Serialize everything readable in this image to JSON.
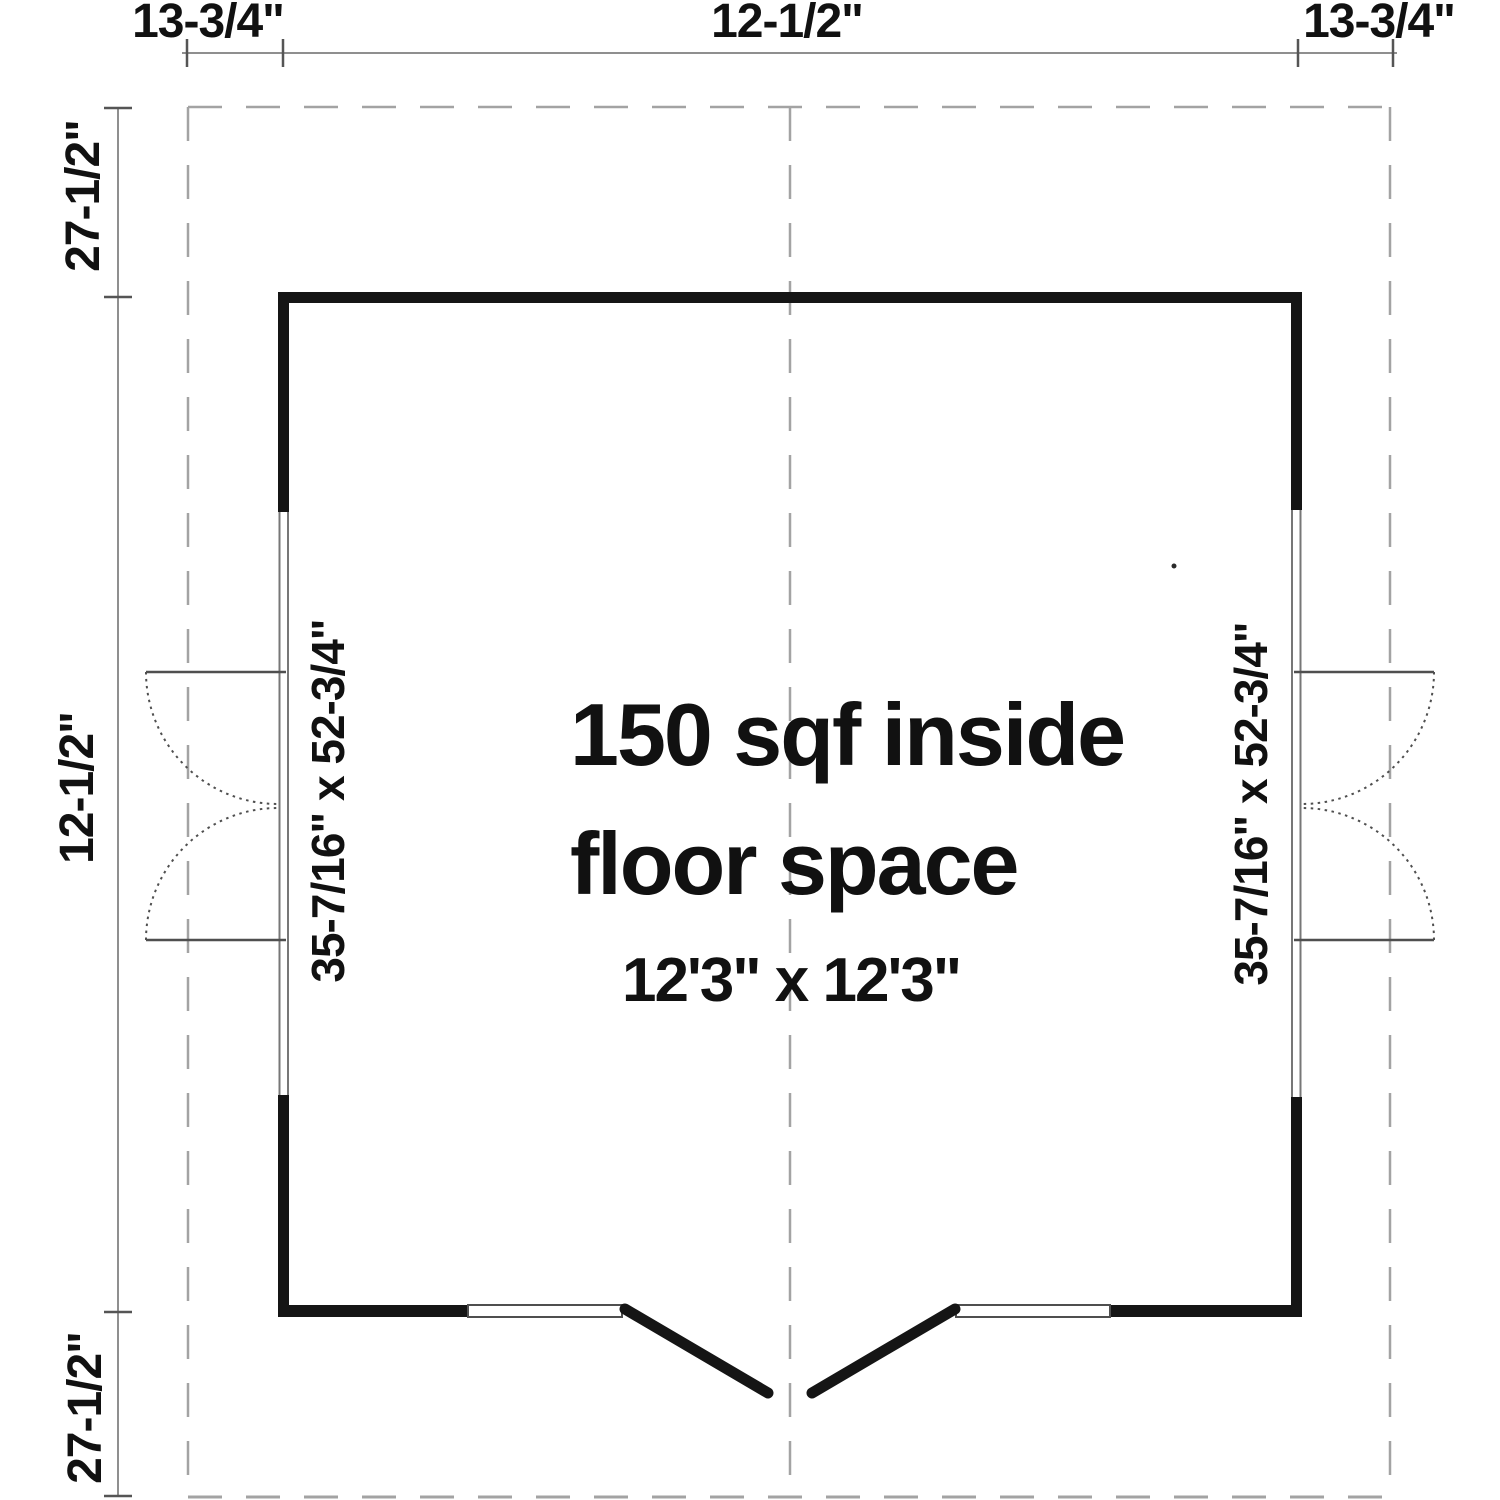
{
  "plan": {
    "dimensions_top": [
      {
        "label": "13-3/4\""
      },
      {
        "label": "12-1/2\""
      },
      {
        "label": "13-3/4\""
      }
    ],
    "dimensions_left": [
      {
        "label": "27-1/2\""
      },
      {
        "label": "12-1/2\""
      },
      {
        "label": "27-1/2\""
      }
    ],
    "left_door_label": "35-7/16\" x 52-3/4\"",
    "right_door_label": "35-7/16\" x 52-3/4\"",
    "center_text_line1": "150 sqf inside",
    "center_text_line2": "floor space",
    "center_text_line3": "12'3\" x 12'3\""
  },
  "colors": {
    "wall": "#151515",
    "guide": "#a3a3a3",
    "dim": "#8f8f8f",
    "tick": "#555555",
    "frame": "#777777",
    "swing": "#4f4f4f",
    "text": "#111111",
    "background": "#ffffff"
  }
}
